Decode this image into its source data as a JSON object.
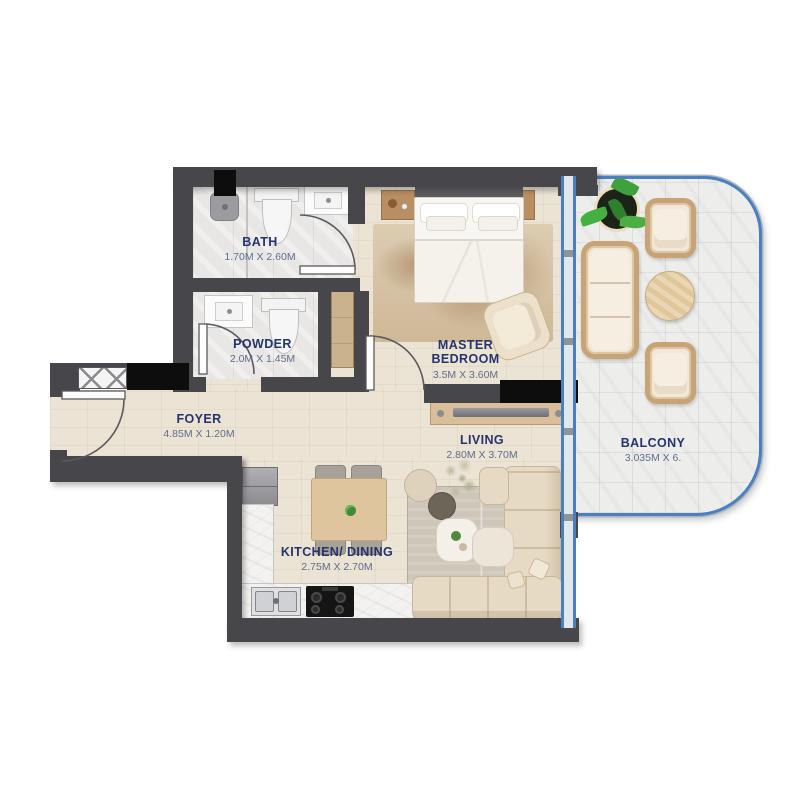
{
  "plan_title": "1-bedroom apartment floor plan",
  "rooms": {
    "bath": {
      "name": "BATH",
      "dims": "1.70M X 2.60M"
    },
    "powder": {
      "name": "POWDER",
      "dims": "2.0M X 1.45M"
    },
    "master_bedroom": {
      "name": "MASTER BEDROOM",
      "dims": "3.5M X 3.60M"
    },
    "foyer": {
      "name": "FOYER",
      "dims": "4.85M X 1.20M"
    },
    "living": {
      "name": "LIVING",
      "dims": "2.80M X 3.70M"
    },
    "kitchen_dining": {
      "name": "KITCHEN/ DINING",
      "dims": "2.75M X 2.70M"
    },
    "balcony": {
      "name": "BALCONY",
      "dims": "3.035M X 6."
    }
  },
  "palette": {
    "wall": "#47474b",
    "floor_wood": "#ebe3d4",
    "floor_tile": "#e8e7e5",
    "balcony_tile": "#edeeec",
    "balcony_frame": "#4a80c2",
    "label_text": "#25346b",
    "dims_text": "#5f6d8c",
    "furniture_beige": "#e7dac4",
    "wicker_tan": "#c7a376",
    "wood_furniture": "#b98e62",
    "marble": "#f3f2f0",
    "fixture_black": "#0d0d0d"
  }
}
